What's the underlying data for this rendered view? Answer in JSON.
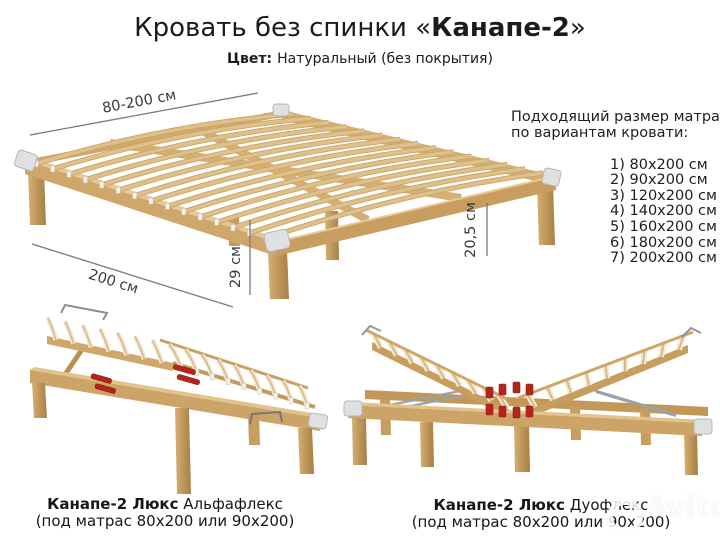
{
  "title": {
    "prefix": "Кровать без спинки «",
    "highlight": "Канапе-2",
    "suffix": "»"
  },
  "subtitle": {
    "label": "Цвет:",
    "value": "Натуральный (без покрытия)"
  },
  "main_bed": {
    "dim_width": "80-200 см",
    "dim_length": "200 см",
    "dim_leg_height": "29 см",
    "dim_clearance": "20,5 см"
  },
  "mattress_panel": {
    "heading_line1": "Подходящий размер матраса",
    "heading_line2": "по вариантам кровати:",
    "sizes": [
      "1) 80x200 см",
      "2) 90x200 см",
      "3) 120x200 см",
      "4) 140x200 см",
      "5) 160x200 см",
      "6) 180x200 см",
      "7) 200x200 см"
    ]
  },
  "variants": {
    "left": {
      "name": "Канапе-2 Люкс",
      "model": "Альфафлекс",
      "note": "(под матрас 80x200 или 90x200)"
    },
    "right": {
      "name": "Канапе-2 Люкс",
      "model": "Дуофлекс",
      "note": "(под матрас 80x200 или 90x200)"
    }
  },
  "watermark": {
    "text": "Avito"
  },
  "colors": {
    "wood_light": "#e3c28c",
    "wood_mid": "#d2ab70",
    "wood_dark": "#b98e52",
    "slat": "#dcbc85",
    "slat_pale": "#f1e8d6",
    "bracket": "#dfe0e2",
    "red_adjuster": "#b3251b",
    "metal": "#9aa1a8",
    "dimension_line": "#7a7a7a",
    "text": "#1b1b1b"
  }
}
